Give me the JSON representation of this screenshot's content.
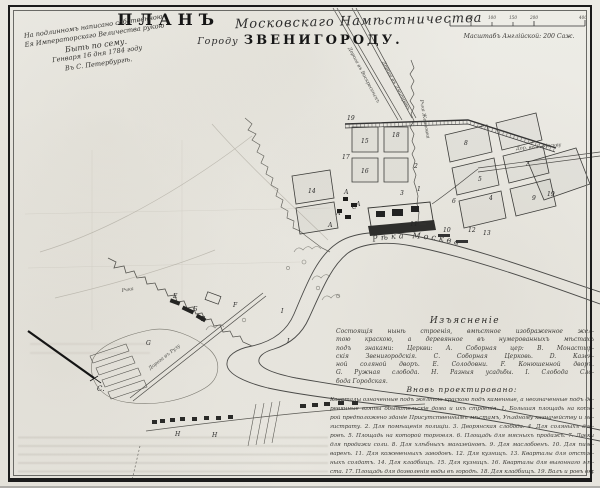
{
  "header": {
    "title_word": "ПЛАНЪ",
    "title_script": "Московскаго Намѣстничества",
    "subtitle_prefix": "Городу",
    "subtitle_city": "ЗВЕНИГОРОДУ."
  },
  "dedication": {
    "lines": [
      "На подлинномъ написано собственною",
      "Ея Императорскаго Величества рукою",
      "Быть по сему.",
      "Генваря 16 дня 1784 году",
      "Въ С. Петербургѣ."
    ]
  },
  "scalebar": {
    "tick_labels": [
      "50",
      "100",
      "150",
      "200",
      "400"
    ],
    "label": "Масштабъ Англійской: 200 Саж."
  },
  "map": {
    "river_label": "Рѣка Москва",
    "road_moscow_label": "Дор. въ Г. Москву",
    "road_north1_label": "Дорога въ Воскресенскъ",
    "road_north2_label": "Дорога въ Дмитровъ",
    "road_sw_label": "Дорога въ Рузу",
    "stream_label": "Рчка Жерновка",
    "stream2_label": "Рчка",
    "compass_label": "С.",
    "labels": [
      "1",
      "2",
      "3",
      "4",
      "5",
      "6",
      "7",
      "8",
      "9",
      "10",
      "11",
      "12",
      "13",
      "14",
      "15",
      "16",
      "17",
      "18",
      "19",
      "19",
      "А",
      "А",
      "А",
      "А",
      "Б",
      "В",
      "С",
      "Е",
      "F",
      "G",
      "I",
      "I",
      "Н",
      "Н"
    ]
  },
  "legend": {
    "title": "Изъясненіе",
    "body_lines": [
      "Состоящія нынѣ строенія, вмѣстное изображенное жел-",
      "тою краскою, а деревянное въ нумерованныхъ мѣстахъ",
      "подъ знаками: Церкви: А. Соборная цер: В. Монастыр-",
      "скія Звенигородскія. С. Соборная Церковь. D. Казен-",
      "ной соляной дворъ. Е. Солодовни. F. Конюшенной дворъ.",
      "G. Ружная слобода. Н. Разныя усадьбы. I. Слобода Сло-",
      "бода Городская."
    ],
    "projected_title": "Вновь проектировано:",
    "projected_lines": [
      "Кварталы означенные подъ желтою краскою подъ каменные, а неозначенные подъ де-",
      "ревянные взяты обывательскіе дома и ихъ строенія. 1. Большая площадь на кото-",
      "рой предположено зданіе Присутственнымъ мѣстамъ, Уѣздному казначейству и ма-",
      "гистрату. 2. Для помѣщенія полиціи. 3. Дворянская слобода. 4. Для соляныхъ дво-",
      "ровъ. 5. Площадь на которой торговля. 6. Площадь для мясныхъ продажъ. 7. Лавки",
      "для продажи соли. 8. Для хлѣбныхъ магазейновъ. 9. Для маслобоенъ. 10. Для пиво-",
      "варенъ. 11. Для кожевенныхъ заводовъ. 12. Для кузницъ. 13. Кварталы для отстав-",
      "ныхъ солдатъ. 14. Для кладбищъ. 15. Для кузницъ. 16. Кварталы для выгоннаго мѣ-",
      "ста. 17. Площадь для дозволенія воды въ городѣ. 18. Для кладбищъ. 19. Валъ и ровъ окружающій городъ."
    ]
  }
}
